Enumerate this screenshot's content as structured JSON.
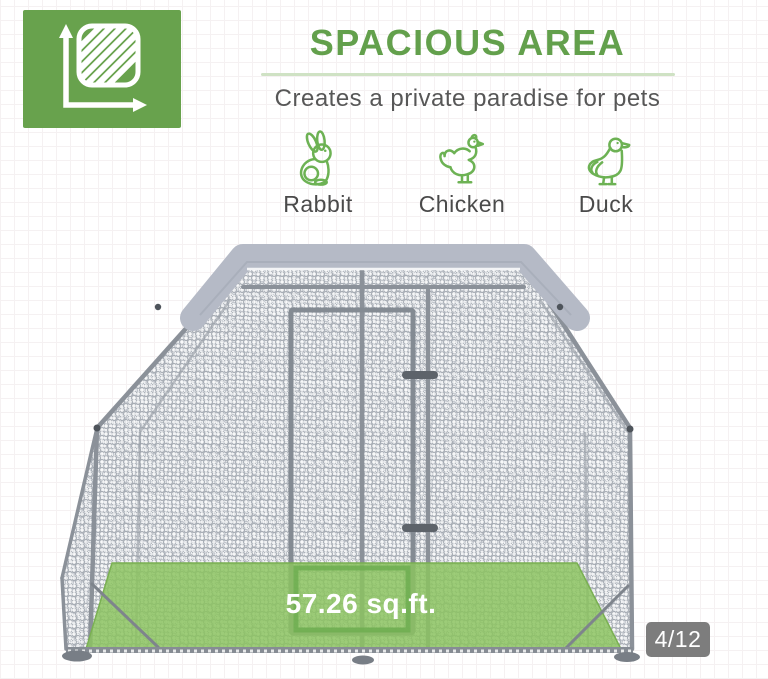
{
  "feature": {
    "title": "SPACIOUS AREA",
    "subtitle": "Creates a private paradise for pets"
  },
  "pets": [
    {
      "name": "Rabbit",
      "icon": "rabbit-icon"
    },
    {
      "name": "Chicken",
      "icon": "chicken-icon"
    },
    {
      "name": "Duck",
      "icon": "duck-icon"
    }
  ],
  "product_image": {
    "floor_area": "57.26 sq.ft."
  },
  "pagination": {
    "current": "4",
    "total": "12",
    "label": "4/12"
  },
  "colors": {
    "accent_green": "#63a04c",
    "icon_box_green": "#68a24d",
    "floor_green": "#8cc45f",
    "cover_gray": "#b5bac6",
    "badge_gray": "#767676"
  }
}
